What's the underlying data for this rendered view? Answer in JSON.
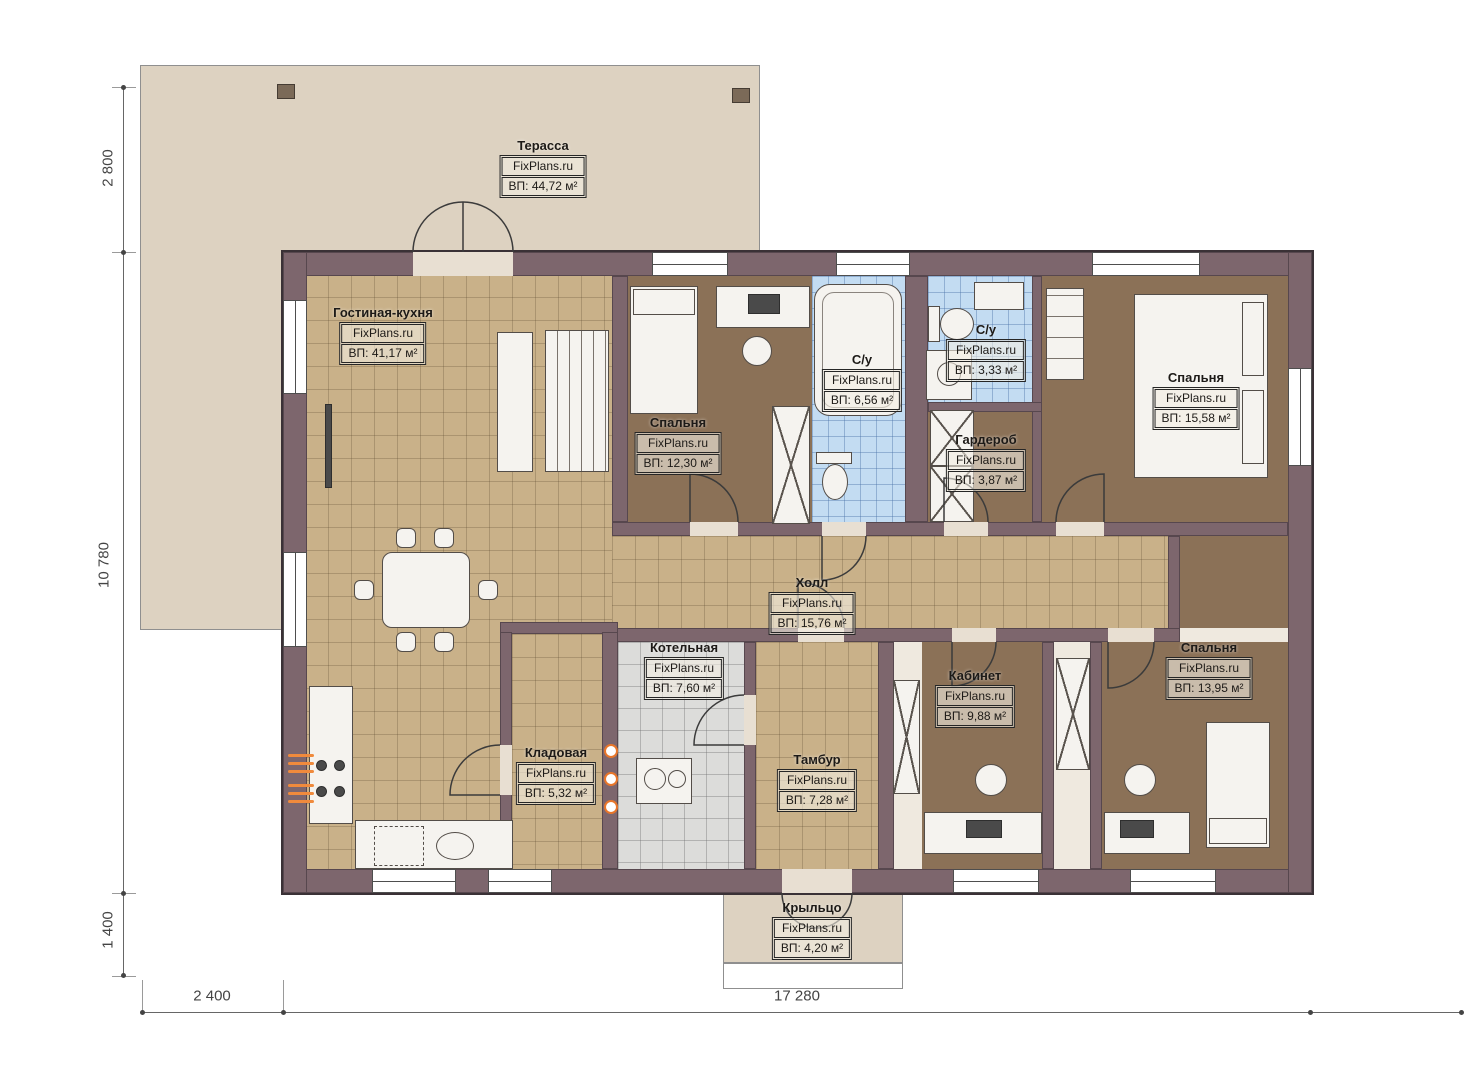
{
  "plan": {
    "watermark": "FixPlans.ru",
    "rooms": [
      {
        "id": "terrace",
        "name": "Терасса",
        "area": "ВП: 44,72 м²"
      },
      {
        "id": "living-kitchen",
        "name": "Гостиная-кухня",
        "area": "ВП: 41,17 м²"
      },
      {
        "id": "bedroom-1",
        "name": "Спальня",
        "area": "ВП: 12,30 м²"
      },
      {
        "id": "bathroom-1",
        "name": "С/у",
        "area": "ВП: 6,56 м²"
      },
      {
        "id": "bathroom-2",
        "name": "С/у",
        "area": "ВП: 3,33 м²"
      },
      {
        "id": "wardrobe",
        "name": "Гардероб",
        "area": "ВП: 3,87 м²"
      },
      {
        "id": "bedroom-2",
        "name": "Спальня",
        "area": "ВП: 15,58 м²"
      },
      {
        "id": "hall",
        "name": "Холл",
        "area": "ВП: 15,76 м²"
      },
      {
        "id": "boiler-room",
        "name": "Котельная",
        "area": "ВП: 7,60 м²"
      },
      {
        "id": "storage",
        "name": "Кладовая",
        "area": "ВП: 5,32 м²"
      },
      {
        "id": "vestibule",
        "name": "Тамбур",
        "area": "ВП: 7,28 м²"
      },
      {
        "id": "office",
        "name": "Кабинет",
        "area": "ВП: 9,88 м²"
      },
      {
        "id": "bedroom-3",
        "name": "Спальня",
        "area": "ВП: 13,95 м²"
      },
      {
        "id": "porch",
        "name": "Крыльцо",
        "area": "ВП: 4,20 м²"
      }
    ],
    "dimensions": {
      "terrace_depth": "2 800",
      "house_height": "10 780",
      "porch_depth": "1 400",
      "terrace_offset": "2 400",
      "house_width": "17 280"
    },
    "colors": {
      "wall": "#7d666d",
      "floor_tile_tan": "#c9b189",
      "floor_carpet_brown": "#8b7157",
      "floor_tile_blue": "#c3dcf2",
      "floor_tile_gray": "#dcdcda",
      "terrace_fill": "#ddd2c1",
      "accent_orange": "#e8762a"
    }
  }
}
